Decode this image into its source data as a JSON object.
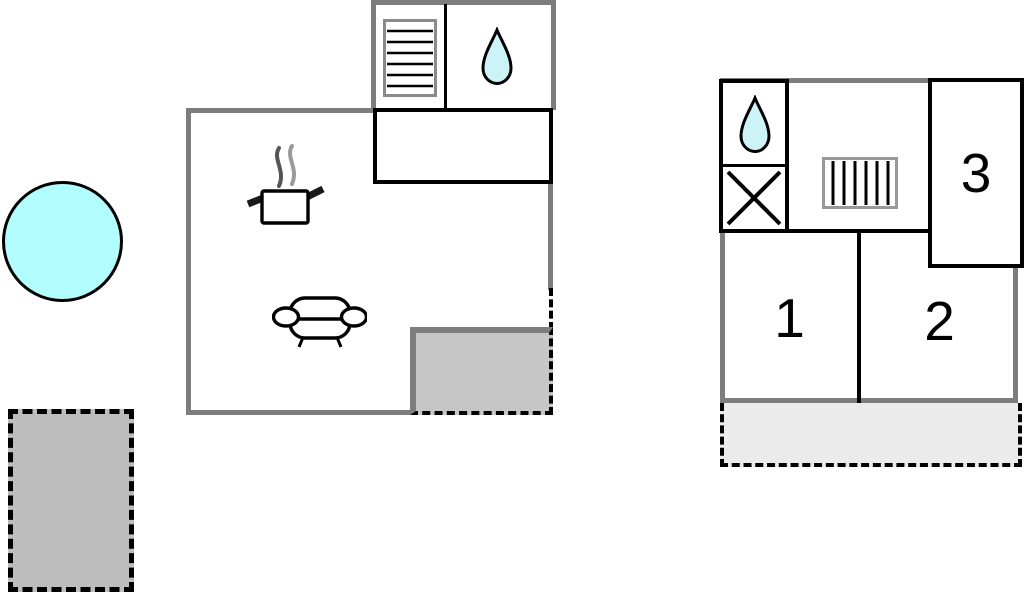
{
  "diagram": {
    "type": "floor-plan",
    "ground_floor": {
      "features": [
        "stairs",
        "bathroom-water-drop",
        "entrance-hall",
        "kitchen-pot",
        "sofa",
        "terrace"
      ]
    },
    "upper_floor": {
      "rooms": [
        {
          "label": "1"
        },
        {
          "label": "2"
        },
        {
          "label": "3"
        }
      ],
      "features": [
        "bathroom-water-drop",
        "shower-x",
        "stairs",
        "terrace"
      ]
    },
    "outdoor": [
      "pool",
      "terrace-plot"
    ],
    "colors": {
      "wall_gray": "#7d7d7d",
      "terrace_dark_gray": "#c6c6c6",
      "terrace_plot_gray": "#bdbdbd",
      "terrace_light_gray": "#ebebeb",
      "pool_cyan": "#b2fdfd",
      "drop_cyan": "#ccf4f6",
      "line_black": "#000000"
    }
  },
  "rooms": {
    "room1": "1",
    "room2": "2",
    "room3": "3"
  }
}
